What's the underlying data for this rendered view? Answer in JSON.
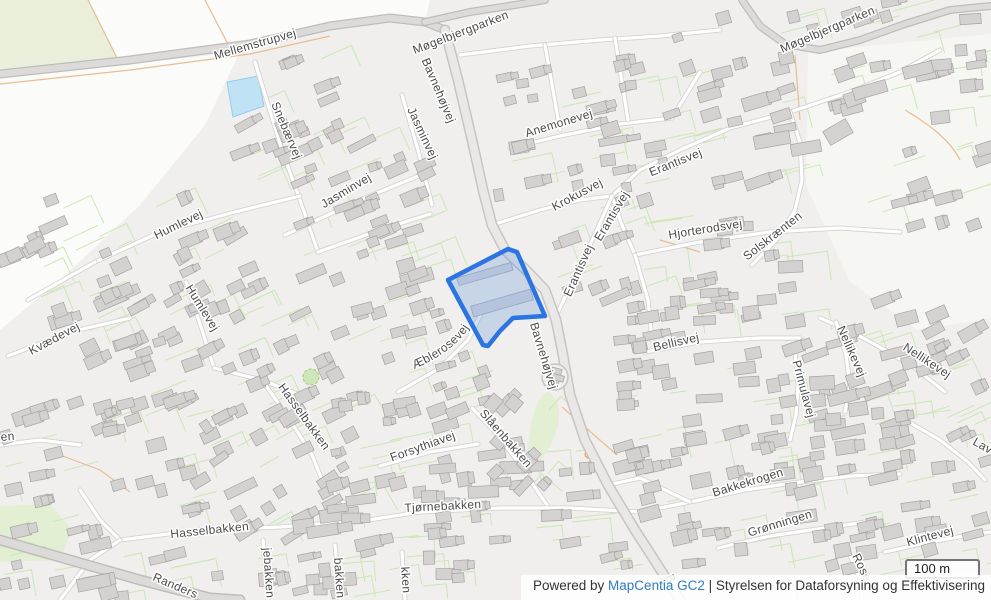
{
  "map": {
    "labels": [
      {
        "text": "Mellemstrupvej",
        "x": 256,
        "y": 48,
        "r": -16
      },
      {
        "text": "Møgelbjergparken",
        "x": 462,
        "y": 36,
        "r": -21
      },
      {
        "text": "Møgelbjergparken",
        "x": 829,
        "y": 33,
        "r": -23
      },
      {
        "text": "Bavnehøjvej",
        "x": 435,
        "y": 92,
        "r": 67
      },
      {
        "text": "Snebærvej",
        "x": 283,
        "y": 132,
        "r": 67
      },
      {
        "text": "Jasminvej",
        "x": 419,
        "y": 135,
        "r": 65
      },
      {
        "text": "Jasminvej",
        "x": 348,
        "y": 194,
        "r": -31
      },
      {
        "text": "Anemonevej",
        "x": 560,
        "y": 127,
        "r": -17
      },
      {
        "text": "Humlevej",
        "x": 180,
        "y": 228,
        "r": -26
      },
      {
        "text": "Humlevej",
        "x": 199,
        "y": 310,
        "r": 58
      },
      {
        "text": "Krokusvej",
        "x": 579,
        "y": 198,
        "r": -28
      },
      {
        "text": "Erantisvej",
        "x": 677,
        "y": 166,
        "r": -22
      },
      {
        "text": "Erantisvej",
        "x": 615,
        "y": 218,
        "r": -59
      },
      {
        "text": "Erantisvej",
        "x": 582,
        "y": 272,
        "r": -66
      },
      {
        "text": "Hjorterodsvej",
        "x": 706,
        "y": 233,
        "r": -9
      },
      {
        "text": "Solskrænten",
        "x": 775,
        "y": 239,
        "r": -38
      },
      {
        "text": "Æblerosevej",
        "curve": "aeblerosevej"
      },
      {
        "text": "Bavnehøjvej",
        "x": 540,
        "y": 357,
        "r": 73
      },
      {
        "text": "Bellisvej",
        "x": 677,
        "y": 346,
        "r": -13
      },
      {
        "text": "Nellikevej",
        "x": 848,
        "y": 353,
        "r": 66
      },
      {
        "text": "Nellikevej",
        "x": 925,
        "y": 364,
        "r": 33
      },
      {
        "text": "Primulavej",
        "x": 800,
        "y": 390,
        "r": 75
      },
      {
        "text": "Kvædevej",
        "x": 56,
        "y": 342,
        "r": -28
      },
      {
        "text": "Hasselbakken",
        "x": 301,
        "y": 419,
        "r": 54
      },
      {
        "text": "Hasselbakken",
        "x": 210,
        "y": 534,
        "r": -6
      },
      {
        "text": "Forsythiavej",
        "x": 424,
        "y": 450,
        "r": -20
      },
      {
        "text": "Slåenbakken",
        "x": 503,
        "y": 441,
        "r": 49
      },
      {
        "text": "Tjørnebakken",
        "x": 443,
        "y": 510,
        "r": -3
      },
      {
        "text": "Bakkekrogen",
        "x": 749,
        "y": 486,
        "r": -17
      },
      {
        "text": "Grønningen",
        "x": 781,
        "y": 527,
        "r": -17
      },
      {
        "text": "Klintevej",
        "x": 931,
        "y": 540,
        "r": -15
      },
      {
        "text": "Randers",
        "x": 152,
        "y": 580,
        "r": 23,
        "a": "start"
      },
      {
        "text": "Rose",
        "x": 852,
        "y": 556,
        "r": 64,
        "a": "start"
      },
      {
        "text": "Lav",
        "x": 972,
        "y": 444,
        "r": 30,
        "a": "start"
      },
      {
        "text": "jebakken",
        "x": 263,
        "y": 548,
        "r": 86,
        "a": "start"
      },
      {
        "text": "bakken",
        "x": 334,
        "y": 558,
        "r": 86,
        "a": "start"
      },
      {
        "text": "kken",
        "x": 401,
        "y": 567,
        "r": 86,
        "a": "start"
      },
      {
        "text": "en",
        "x": 1,
        "y": 441,
        "r": -5,
        "a": "start"
      },
      {
        "text": "B",
        "x": 667,
        "y": 580,
        "r": 70
      }
    ],
    "colors": {
      "bg": "#f0efed",
      "open": "#fbfbf9",
      "open_tint": "#f6f6f3",
      "field_green": "#e9efdb",
      "grass": "#e2efd3",
      "pond_fill": "#bfe2f5",
      "pond_stroke": "#96cdea",
      "building_fill": "#d3d2d0",
      "building_stroke": "#a5a4a1",
      "parcel_line": "#c9e5b4",
      "orange": "#e8bd92",
      "road_casing": "#d4d3d1",
      "road_fill": "#ffffff",
      "major_fill": "#dcdbd9",
      "major_casing": "#bebdbb",
      "bav_fill": "#e9e8e6",
      "bav_casing": "#c6c5c3",
      "label": "#4c4c4c",
      "halo": "#ffffff",
      "highlight_stroke": "#2b74e2",
      "highlight_fill": "rgba(74,134,216,0.25)",
      "highlight_building": "#b5c3dd",
      "highlight_building_stroke": "#93a5c5"
    }
  },
  "scale_bar": {
    "label": "100 m"
  },
  "attribution": {
    "powered_by": "Powered by ",
    "link_label": "MapCentia GC2",
    "separator": " | ",
    "org": "Styrelsen for Dataforsyning og Effektivisering"
  }
}
